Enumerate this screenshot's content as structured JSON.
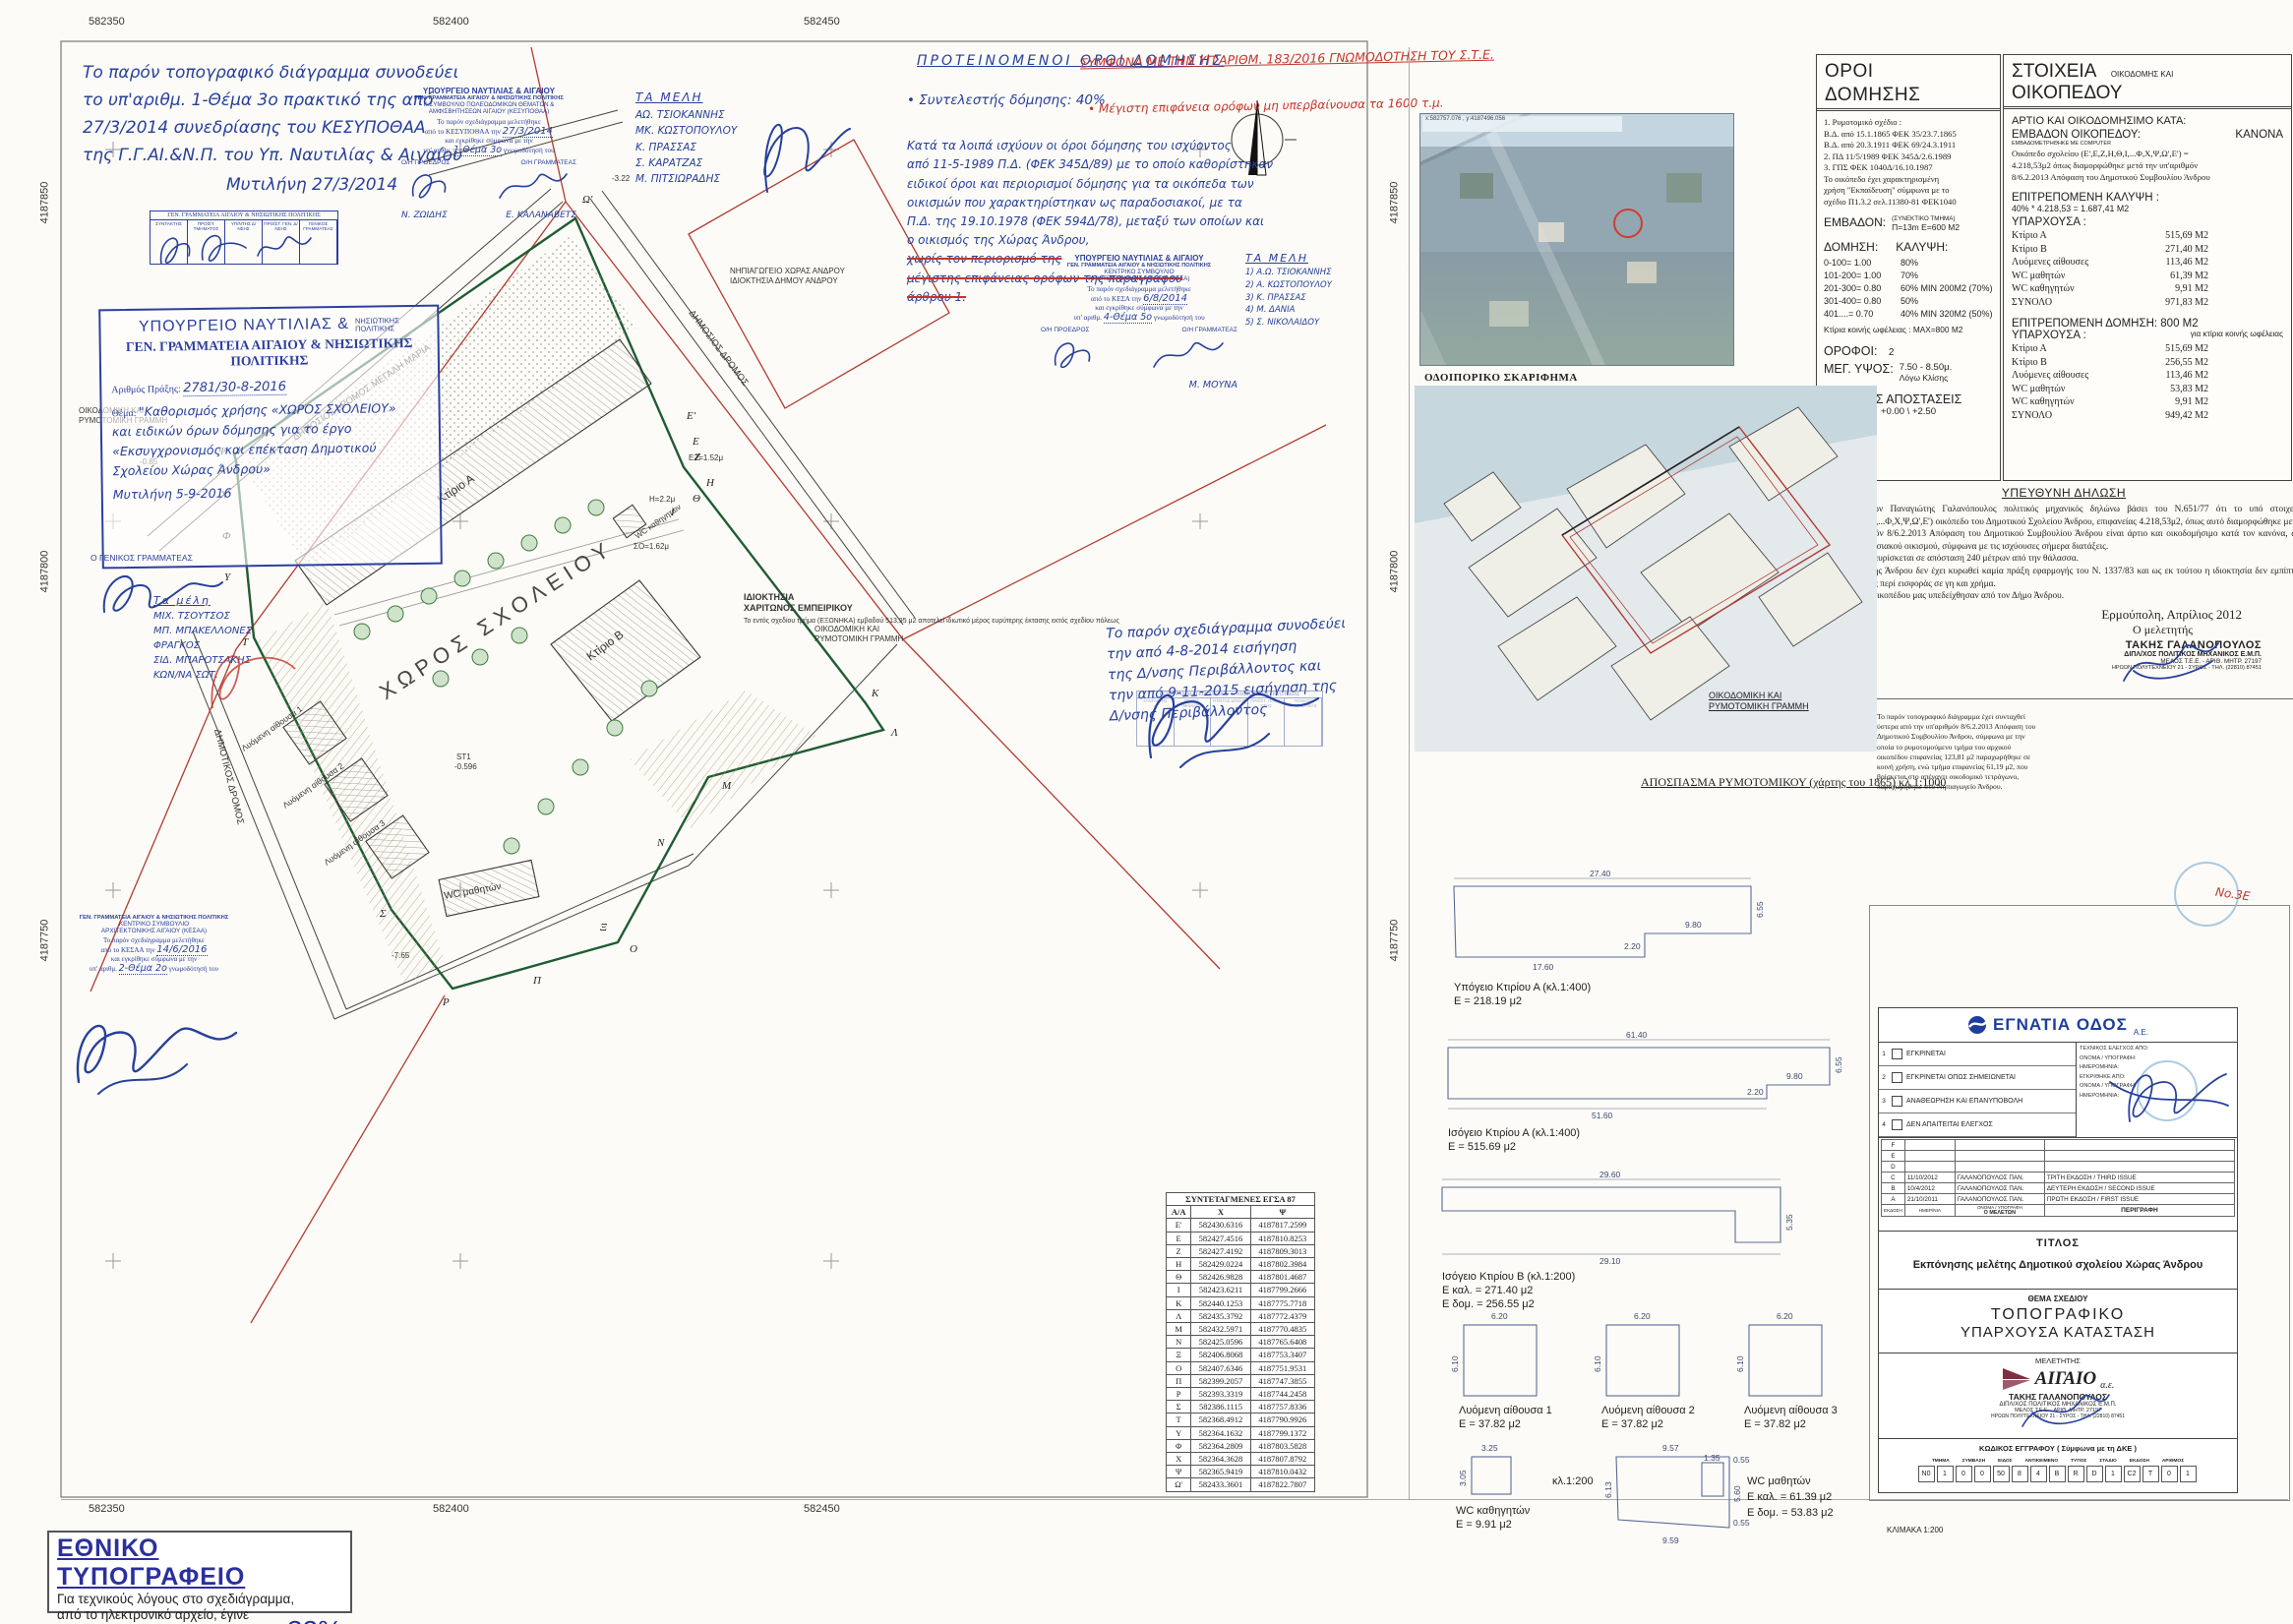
{
  "grid": {
    "top": [
      "582350",
      "582400",
      "582450"
    ],
    "bottom": [
      "582350",
      "582400",
      "582450"
    ],
    "left": [
      "4187850",
      "4187800",
      "4187750"
    ],
    "right": [
      "4187850",
      "4187800",
      "4187750"
    ]
  },
  "notes": {
    "top_left": "Το παρόν τοπογραφικό διάγραμμα συνοδεύει\nτο υπ'αριθμ. 1-Θέμα 3ο πρακτικό της από\n27/3/2014 συνεδρίασης του ΚΕΣΥΠΟΘΑΑ\nτης Γ.Γ.ΑΙ.&Ν.Π. του Υπ. Ναυτιλίας & Αιγαίου",
    "top_left_date": "Μυτιλήνη 27/3/2014",
    "mid_right": "Το παρόν σχεδιάγραμμα συνοδεύει\nτην από 4-8-2014 εισήγηση\nτης Δ/νσης Περιβάλλοντος και\nτην από 9-11-2015 εισήγηση της\nΔ/νσης Περιβάλλοντος"
  },
  "proposed": {
    "title": "ΠΡΟΤΕΙΝΟΜΕΝΟΙ ΟΡΟΙ ΔΟΜΗΣΗΣ",
    "red1": "ΣΥΜΦΩΝΑ ΜΕ ΤΗΝ ΥΠ'ΑΡΙΘΜ. 183/2016 ΓΝΩΜΟΔΟΤΗΣΗ ΤΟΥ Σ.Τ.Ε.",
    "red2": "• Μέγιστη επιφάνεια ορόφων μη υπερβαίνουσα τα 1600 τ.μ.",
    "line1": "• Συντελεστής δόμησης:  40%",
    "body": "Κατά τα λοιπά ισχύουν οι όροι δόμησης του ισχύοντος\nαπό 11-5-1989 Π.Δ. (ΦΕΚ 345Δ/89) με το οποίο καθορίστηκαν\nειδικοί όροι και περιορισμοί δόμησης για τα οικόπεδα των\nοικισμών που χαρακτηρίστηκαν ως παραδοσιακοί, με τα\nΠ.Δ. της 19.10.1978 (ΦΕΚ 594Δ/78), μεταξύ των οποίων και\nο οικισμός της Χώρας Άνδρου,",
    "struck": "χωρίς τον περιορισμό της\nμέγιστης επιφάνειας ορόφων της παραγράφου\nάρθρου 1."
  },
  "stamps": {
    "sig_table": {
      "header": "ΓΕΝ. ΓΡΑΜΜΑΤΕΙΑ ΑΙΓΑΙΟΥ & ΝΗΣΙΩΤΙΚΗΣ ΠΟΛΙΤΙΚΗΣ",
      "cols": [
        "ΣΥΝΤΑΚΤΗΣ",
        "ΠΡΟΪΣΤ. ΤΜΗΜΑΤΟΣ",
        "ΥΠ/ΝΤΗΣ Δ/ΝΣΗΣ",
        "ΠΡΟΪΣΤ. ΓΕΝ. Δ/ΝΣΗΣ",
        "ΓΕΝΙΚΟΣ ΓΡΑΜΜΑΤΕΑΣ"
      ]
    },
    "permit": {
      "title1a": "ΥΠΟΥΡΓΕΙΟ ΝΑΥΤΙΛΙΑΣ &",
      "title1b": "ΝΗΣΙΩΤΙΚΗΣ\nΠΟΛΙΤΙΚΗΣ",
      "title2": "ΓΕΝ. ΓΡΑΜΜΑΤΕΙΑ ΑΙΓΑΙΟΥ & ΝΗΣΙΩΤΙΚΗΣ ΠΟΛΙΤΙΚΗΣ",
      "num_label": "Αριθμός Πράξης:",
      "num_value": "2781/30-8-2016",
      "subject_label": "Θέμα:",
      "subject_value": "\"Καθορισμός χρήσης «ΧΩΡΟΣ ΣΧΟΛΕΙΟΥ»\nκαι ειδικών όρων δόμησης για το έργο\n«Εκσυγχρονισμός και επέκταση Δημοτικού\nΣχολείου Χώρας Άνδρου»",
      "date_value": "Μυτιλήνη 5-9-2016",
      "signer": "Ο ΓΕΝΙΚΟΣ ΓΡΑΜΜΑΤΕΑΣ"
    },
    "kesypothaa": {
      "l1": "ΥΠΟΥΡΓΕΙΟ ΝΑΥΤΙΛΙΑΣ & ΑΙΓΑΙΟΥ",
      "l2": "ΓΕΝ. ΓΡΑΜΜΑΤΕΙΑ ΑΙΓΑΙΟΥ & ΝΗΣΙΩΤΙΚΗΣ ΠΟΛΙΤΙΚΗΣ",
      "l3": "Κ.ΣΥΜΒΟΥΛΙΟ ΠΟΛΕΟΔΟΜΙΚΩΝ ΘΕΜΑΤΩΝ &",
      "l4": "ΑΜΦΙΣΒΗΤΗΣΕΩΝ ΑΙΓΑΙΟΥ (ΚΕΣΥΠΟΘΑΑ)",
      "l5": "Το παρόν σχεδιάγραμμα μελετήθηκε",
      "l6a": "από το ΚΕΣΥΠΟΘΑΑ την",
      "l6b": "27/3/2014",
      "l7": "και εγκρίθηκε σύμφωνα με την",
      "l8a": "υπ' αριθμ.",
      "l8b": "1-Θέμα 3ο",
      "l8c": "γνωμοδότησή του",
      "president": "Ο/Η ΠΡΟΕΔΡΟΣ",
      "secretary": "Ο/Η ΓΡΑΜΜΑΤΕΑΣ",
      "president_name": "Ν. ΖΩΙΔΗΣ",
      "secretary_name": "Ε. ΚΑΛΑΝΑΒΕΤΣ"
    },
    "kesa": {
      "l1": "ΥΠΟΥΡΓΕΙΟ ΝΑΥΤΙΛΙΑΣ & ΑΙΓΑΙΟΥ",
      "l2": "ΓΕΝ. ΓΡΑΜΜΑΤΕΙΑ ΑΙΓΑΙΟΥ & ΝΗΣΙΩΤΙΚΗΣ ΠΟΛΙΤΙΚΗΣ",
      "l3": "ΚΕΝΤΡΙΚΟ ΣΥΜΒΟΥΛΙΟ",
      "l4": "ΑΡΧΙΤΕΚΤΟΝΙΚΗΣ ΑΙΓΑΙΟΥ (ΚΕΣΑ)",
      "l5": "Το παρόν σχεδιάγραμμα μελετήθηκε",
      "l6a": "από το ΚΕΣΑ την",
      "l6b": "6/8/2014",
      "l7": "και εγκρίθηκε σύμφωνα με την",
      "l8a": "υπ' αριθμ.",
      "l8b": "4-Θέμα 5ο",
      "l8c": "γνωμοδότησή του",
      "president": "Ο/Η ΠΡΟΕΔΡΟΣ",
      "secretary": "Ο/Η ΓΡΑΜΜΑΤΕΑΣ",
      "secretary_name": "Μ. ΜΟΥΝΑ"
    },
    "kesaa": {
      "l1": "ΓΕΝ. ΓΡΑΜΜΑΤΕΙΑ ΑΙΓΑΙΟΥ & ΝΗΣΙΩΤΙΚΗΣ ΠΟΛΙΤΙΚΗΣ",
      "l2": "ΚΕΝΤΡΙΚΟ ΣΥΜΒΟΥΛΙΟ",
      "l3": "ΑΡΧΙΤΕΚΤΟΝΙΚΗΣ ΑΙΓΑΙΟΥ (ΚΕΣΑΑ)",
      "l4": "Το παρόν σχεδιάγραμμα μελετήθηκε",
      "l5a": "από το ΚΕΣΑΑ την",
      "l5b": "14/6/2016",
      "l6": "και εγκρίθηκε σύμφωνα με την",
      "l7a": "υπ' αριθμ.",
      "l7b": "2-Θέμα 2ο",
      "l7c": "γνωμοδότησή του"
    },
    "members1": {
      "title": "ΤΑ ΜΕΛΗ",
      "names": "ΑΩ. ΤΣΙΟΚΑΝΝΗΣ\nΜΚ. ΚΩΣΤΟΠΟΥΛΟΥ\nΚ. ΠΡΑΣΣΑΣ\nΣ. ΚΑΡΑΤΖΑΣ\nΜ. ΠΙΤΣΙΩΡΑΔΗΣ"
    },
    "members2": {
      "title": "ΤΑ ΜΕΛΗ",
      "names": "1) Α.Ω. ΤΣΙΟΚΑΝΝΗΣ\n2) Α. ΚΩΣΤΟΠΟΥΛΟΥ\n3) Κ. ΠΡΑΣΣΑΣ\n4) Μ. ΔΑΝΙΑ\n5) Σ. ΝΙΚΟΛΑΙΔΟΥ"
    },
    "members3": {
      "title": "Τα μέλη",
      "names": "ΜΙΧ. ΤΣΟΥΤΣΟΣ\nΜΠ. ΜΠΑΚΕΛΛΟΝΕΣ\nΦΡΑΓΚΟΣ\nΣΙΔ. ΜΠΑΡΟΤΣΑΚΗΣ\nΚΩΝ/ΝΑ ΣΩΤ."
    },
    "red_note": "Νο.3Ε"
  },
  "plan": {
    "school_area_label": "ΧΩΡΟΣ ΣΧΟΛΕΙΟΥ",
    "ktirio_a": "Κτίριο Α",
    "ktirio_b": "Κτίριο Β",
    "lyomeni_1": "Λυόμενη αίθουσα 1",
    "lyomeni_2": "Λυόμενη αίθουσα 2",
    "lyomeni_3": "Λυόμενη αίθουσα 3",
    "wc_math": "WC μαθητών",
    "wc_kath": "WC καθηγητών",
    "road1": "ΔΗΜΟΣΙΟΣ ΔΡΟΜΟΣ ΜΕΓΑΛΗ ΜΑΡΙΑ",
    "road2": "ΔΗΜΟΤΙΚΟΣ ΔΡΟΜΟΣ",
    "road3": "ΔΗΜΟΣΙΟΣ ΔΡΟΜΟΣ",
    "oikod_grammi_1": "ΟΙΚΟΔΟΜΙΚΗ ΚΑΙ",
    "oikod_grammi_2": "ΡΥΜΟΤΟΜΙΚΗ ΓΡΑΜΜΗ",
    "idioktisia_1": "ΙΔΙΟΚΤΗΣΙΑ",
    "idioktisia_2": "ΧΑΡΙΤΩΝΟΣ ΕΜΠΕΙΡΙΚΟΥ",
    "idioktisia_note": "Το εντός σχεδίου τμήμα\n(ΕΞΩΝΗΚΑ) εμβαδού 513,95 μ2\nαποτελεί ιδιωτικό μέρος\nευρύτερης έκτασης εκτός\nσχεδίου πόλεως",
    "nipiagogeio_1": "ΝΗΠΙΑΓΩΓΕΙΟ ΧΩΡΑΣ ΑΝΔΡΟΥ",
    "nipiagogeio_2": "ΙΔΙΟΚΤΗΣΙΑ ΔΗΜΟΥ ΑΝΔΡΟΥ",
    "st1a": "ST1",
    "st1b": "-0.596",
    "lv1": "-0.85",
    "lv2": "-3.22",
    "lv3": "-7.65",
    "lv4": "ΕΖ=1.52μ",
    "lv5": "Η=2.2μ",
    "lv6": "ΣΟ=1.62μ",
    "vertex_letters": [
      "Ω'",
      "Ε'",
      "Ε",
      "Ζ",
      "Η",
      "Θ",
      "Ι",
      "Κ",
      "Λ",
      "Μ",
      "Ν",
      "Ξ",
      "Ο",
      "Π",
      "Ρ",
      "Σ",
      "Τ",
      "Υ",
      "Φ",
      "Χ",
      "Ψ"
    ]
  },
  "aerial": {
    "caption": "ΟΔΟΙΠΟΡΙΚΟ ΣΚΑΡΙΦΗΜΑ",
    "coords": "x:582757.076 , y:4187496.056"
  },
  "oroi": {
    "t1": "ΟΡΟΙ",
    "t2": "ΔΟΜΗΣΗΣ",
    "law": "1. Ρυμοτομικό σχέδιο :\n    Β.Δ. από 15.1.1865 ΦΕΚ 35/23.7.1865\n    Β.Δ. από 20.3.1911 ΦΕΚ 69/24.3.1911\n2. ΠΔ 11/5/1989 ΦΕΚ 345Δ/2.6.1989\n3. ΓΠΣ ΦΕΚ 1040Δ/16.10.1987\n    Το οικόπεδο έχει χαρακτηρισμένη\n    χρήση \"Εκπαίδευση\" σύμφωνα με το\n    σχέδιο Π1.3.2 σελ.11380-81 ΦΕΚ1040",
    "emvadon_label": "ΕΜΒΑΔΟΝ:",
    "emvadon_note": "(ΣΥΝΕΚΤΙΚΟ ΤΜΗΜΑ)",
    "emvadon_value": "Π=13m  Ε=600 Μ2",
    "domisi_label": "ΔΟΜΗΣΗ:",
    "kalypsi_label": "ΚΑΛΥΨΗ:",
    "rows": [
      [
        "0-100= 1.00",
        "80%"
      ],
      [
        "101-200= 1.00",
        "70%"
      ],
      [
        "201-300= 0.80",
        "60% MIN 200M2 (70%)"
      ],
      [
        "301-400= 0.80",
        "50%"
      ],
      [
        "401....= 0.70",
        "40% MIN 320M2 (50%)"
      ]
    ],
    "koinis": "Κτίρια κοινής ωφέλειας : MAX=800 M2",
    "orofoi_label": "ΟΡΟΦΟΙ:",
    "orofoi_value": "2",
    "ypsos_label": "ΜΕΓ. ΥΨΟΣ:",
    "ypsos_value": "7.50 - 8.50μ.",
    "ypsos_note": "Λόγω Κλίσης",
    "plagies": "ΠΛΑΓΕΙΕΣ ΑΠΟΣΤΑΣΕΙΣ",
    "plagies_value": "+0.00 \\ +2.50"
  },
  "stoixeia": {
    "t1": "ΣΤΟΙΧΕΙΑ",
    "t1b": "ΟΙΚΟΔΟΜΗΣ ΚΑΙ",
    "t2": "ΟΙΚΟΠΕΔΟΥ",
    "artio": "ΑΡΤΙΟ ΚΑΙ ΟΙΚΟΔΟΜΗΣΙΜΟ ΚΑΤΑ:",
    "kanona": "ΚΑΝΟΝΑ",
    "emv_label": "ΕΜΒΑΔΟΝ ΟΙΚΟΠΕΔΟΥ:",
    "emv_note": "ΕΜΒΑΔΟΜΕΤΡΗΘΗΚΕ ΜΕ COMPUTER",
    "emv_text": "Οικόπεδο σχολείου (Ε',Ε,Ζ,Η,Θ,Ι,...Φ,Χ,Ψ,Ω',Ε') =\n4.218,53μ2 όπως διαμορφώθηκε μετά την υπ'αριθμόν\n8/6.2.2013 Απόφαση του Δημοτικού Συμβουλίου Άνδρου",
    "kalypsi_title": "ΕΠΙΤΡΕΠΟΜΕΝΗ ΚΑΛΥΨΗ :",
    "kalypsi_calc": "40% * 4.218,53 = 1.687,41 Μ2",
    "yparxousa1": "ΥΠΑΡΧΟΥΣΑ :",
    "table1": [
      {
        "label": "Κτίριο Α",
        "value": "515,69 Μ2"
      },
      {
        "label": "Κτίριο Β",
        "value": "271,40 Μ2"
      },
      {
        "label": "Λυόμενες αίθουσες",
        "value": "113,46 Μ2"
      },
      {
        "label": "WC μαθητών",
        "value": "61,39 Μ2"
      },
      {
        "label": "WC καθηγητών",
        "value": "9,91 Μ2"
      },
      {
        "label": "ΣΥΝΟΛΟ",
        "value": "971,83 Μ2"
      }
    ],
    "domisi_title": "ΕΠΙΤΡΕΠΟΜΕΝΗ ΔΟΜΗΣΗ: 800 Μ2",
    "domisi_note": "για κτίρια κοινής ωφέλειας",
    "yparxousa2": "ΥΠΑΡΧΟΥΣΑ :",
    "table2": [
      {
        "label": "Κτίριο Α",
        "value": "515,69 Μ2"
      },
      {
        "label": "Κτίριο Β",
        "value": "256,55 Μ2"
      },
      {
        "label": "Λυόμενες αίθουσες",
        "value": "113,46 Μ2"
      },
      {
        "label": "WC μαθητών",
        "value": "53,83 Μ2"
      },
      {
        "label": "WC καθηγητών",
        "value": "9,91 Μ2"
      },
      {
        "label": "ΣΥΝΟΛΟ",
        "value": "949,42 Μ2"
      }
    ]
  },
  "dilosi": {
    "title": "ΥΠΕΥΘΥΝΗ ΔΗΛΩΣΗ",
    "body": "Ο υπογράφων Παναγιώτης Γαλανόπουλος πολιτικός μηχανικός δηλώνω βάσει του Ν.651/77 ότι το υπό στοιχεία (Ε',Ε,Ζ,Η,Θ,Ι,...Φ,Χ,Ψ,Ω',Ε') οικόπεδο του Δημοτικού Σχολείου Άνδρου, επιφανείας 4.218,53μ2, όπως αυτό διαμορφώθηκε μετά την υπ'αριθμόν 8/6.2.2013 Απόφαση του Δημοτικού Συμβουλίου Άνδρου είναι άρτιο και οικοδομήσιμο κατά τον κανόνα, ως εντός παραδοσιακού οικισμού, σύμφωνα με τις ισχύουσες σήμερα διατάξεις.\nΤο οικόπεδο ευρίσκεται σε απόσταση 240 μέτρων από την θάλασσα.\nΣτην χώρα της Άνδρου δεν έχει κυρωθεί καμία πράξη εφαρμογής του Ν. 1337/83 και ως εκ τούτου η ιδιοκτησία δεν εμπίπτει στις διατάξεις περί εισφοράς σε γη και χρήμα.\nΤα όρια του οικοπέδου μας υπεδείχθησαν από τον Δήμο Άνδρου.",
    "place": "Ερμούπολη, Απρίλιος 2012",
    "role": "Ο μελετητής",
    "eng1": "ΤΑΚΗΣ ΓΑΛΑΝΟΠΟΥΛΟΣ",
    "eng2": "ΔΙΠΛ/ΧΟΣ ΠΟΛΙΤΙΚΟΣ ΜΗΧΑΝΙΚΟΣ Ε.Μ.Π.",
    "eng3": "ΜΕΛΟΣ Τ.Ε.Ε. - ΑΡΙΘ. ΜΗΤΡ. 27197",
    "eng4": "ΗΡΩΩΝ ΠΟΛΥΤΕΧΝΕΙΟΥ 21 - ΣΥΡΟΣ - ΤΗΛ. (22810) 87451"
  },
  "rymotomiko": {
    "label_1": "ΟΙΚΟΔΟΜΙΚΗ ΚΑΙ",
    "label_2": "ΡΥΜΟΤΟΜΙΚΗ ΓΡΑΜΜΗ",
    "caption": "ΑΠΟΣΠΑΣΜΑ ΡΥΜΟΤΟΜΙΚΟΥ (χάρτης του 1865) κλ 1:1000",
    "note": "Το παρόν τοπογραφικό διάγραμμα έχει συνταχθεί ύστερα από την υπ'αριθμόν 8/6.2.2013 Απόφαση του Δημοτικού Συμβουλίου Άνδρου, σύμφωνα με την οποία το ρυμοτομούμενο τμήμα του αρχικού οικοπέδου επιφανείας 123,81 μ2 παραχωρήθηκε σε κοινή χρήση, ενώ τμήμα επιφανείας 61,19 μ2, που βρίσκεται στο απέναντι οικοδομικό τετράγωνο, παραχωρήθηκε στο Νηπιαγωγείο Άνδρου."
  },
  "floor_plans": {
    "f1_caption": "Υπόγειο Κτιρίου Α (κλ.1:400)",
    "f1_area": "Ε = 218.19 μ2",
    "f1_d1": "27.40",
    "f1_d2": "6.55",
    "f1_d3": "9.80",
    "f1_d4": "2.20",
    "f1_d5": "17.60",
    "f2_caption": "Ισόγειο Κτιρίου Α (κλ.1:400)",
    "f2_area": "Ε = 515.69 μ2",
    "f2_d1": "61.40",
    "f2_d2": "6.55",
    "f2_d3": "9.80",
    "f2_d4": "2.20",
    "f2_d5": "51.60",
    "f3_caption": "Ισόγειο Κτιρίου Β (κλ.1:200)",
    "f3_area1": "Ε καλ. = 271.40 μ2",
    "f3_area2": "Ε δομ. = 256.55 μ2",
    "f3_d1": "29.60",
    "f3_d2": "29.10",
    "f3_d3": "5.35",
    "l_caption1": "Λυόμενη αίθουσα 1",
    "l_caption2": "Λυόμενη αίθουσα 2",
    "l_caption3": "Λυόμενη αίθουσα 3",
    "l_area": "Ε = 37.82 μ2",
    "l_d1": "6.20",
    "l_d2": "6.10",
    "wck_caption": "WC καθηγητών",
    "wck_area": "Ε = 9.91 μ2",
    "wck_d1": "3.25",
    "wck_d2": "3.05",
    "scale": "κλ.1:200",
    "wcm_caption": "WC μαθητών",
    "wcm_area1": "Ε καλ. = 61.39 μ2",
    "wcm_area2": "Ε δομ. = 53.83 μ2",
    "wcm_d1": "9.57",
    "wcm_d2": "6.13",
    "wcm_d3": "5.60",
    "wcm_d4": "9.59",
    "wcm_d5": "1.35",
    "wcm_d6": "0.55",
    "wcm_d7": "0.55"
  },
  "title_block": {
    "company": "ΕΓΝΑΤΙΑ ΟΔΟΣ",
    "company_suffix": "Α.Ε.",
    "approvals": [
      {
        "num": "1",
        "label": "ΕΓΚΡΙΝΕΤΑΙ"
      },
      {
        "num": "2",
        "label": "ΕΓΚΡΙΝΕΤΑΙ ΟΠΩΣ ΣΗΜΕΙΩΝΕΤΑΙ"
      },
      {
        "num": "3",
        "label": "ΑΝΑΘΕΩΡΗΣΗ ΚΑΙ ΕΠΑΝΥΠΟΒΟΛΗ"
      },
      {
        "num": "4",
        "label": "ΔΕΝ ΑΠΑΙΤΕΙΤΑΙ ΕΛΕΓΧΟΣ"
      }
    ],
    "check_labels": [
      "ΤΕΧΝΙΚΟΣ ΕΛΕΓΧΟΣ ΑΠΟ:",
      "ΟΝΟΜΑ / ΥΠΟΓΡΑΦΗ:",
      "ΗΜΕΡΟΜΗΝΙΑ:",
      "ΕΓΚΡΙΘΗΚΕ ΑΠΟ:",
      "ΟΝΟΜΑ / ΥΠΟΓΡΑΦΗ:",
      "ΗΜΕΡΟΜΗΝΙΑ:"
    ],
    "revisions": [
      {
        "rev": "F",
        "date": "",
        "name": "",
        "desc": ""
      },
      {
        "rev": "E",
        "date": "",
        "name": "",
        "desc": ""
      },
      {
        "rev": "D",
        "date": "",
        "name": "",
        "desc": ""
      },
      {
        "rev": "C",
        "date": "11/10/2012",
        "name": "ΓΑΛΑΝΟΠΟΥΛΟΣ ΠΑΝ.",
        "desc": "ΤΡΙΤΗ ΕΚΔΟΣΗ / THIRD ISSUE"
      },
      {
        "rev": "B",
        "date": "10/4/2012",
        "name": "ΓΑΛΑΝΟΠΟΥΛΟΣ ΠΑΝ.",
        "desc": "ΔΕΥΤΕΡΗ ΕΚΔΟΣΗ / SECOND ISSUE"
      },
      {
        "rev": "A",
        "date": "21/10/2011",
        "name": "ΓΑΛΑΝΟΠΟΥΛΟΣ ΠΑΝ.",
        "desc": "ΠΡΩΤΗ ΕΚΔΟΣΗ / FIRST ISSUE"
      }
    ],
    "rf1": "ΕΚΔΟΣΗ",
    "rf2": "ΗΜΕΡ/ΝΙΑ",
    "rf3": "ΟΝΟΜΑ / ΥΠΟΓΡΑΦΗ",
    "rf4": "Ο ΜΕΛΕΤΩΝ",
    "rf5": "ΠΕΡΙΓΡΑΦΗ",
    "titlos_label": "ΤΙΤΛΟΣ",
    "titlos": "Εκπόνησης μελέτης Δημοτικού σχολείου Χώρας Άνδρου",
    "thema_label": "ΘΕΜΑ ΣΧΕΔΙΟΥ",
    "thema1": "ΤΟΠΟΓΡΑΦΙΚΟ",
    "thema2": "ΥΠΑΡΧΟΥΣΑ ΚΑΤΑΣΤΑΣΗ",
    "meletitis_label": "ΜΕΛΕΤΗΤΗΣ",
    "aigaio": "ΑΙΓΑΙΟ",
    "aigaio_suffix": "α.ε.",
    "kodikos_label": "ΚΩΔΙΚΟΣ ΕΓΓΡΑΦΟΥ ( Σύμφωνα με τη ΔΚΕ )",
    "code_labels": [
      "ΤΜΗΜΑ",
      "ΣΥΜΒΑΣΗ",
      "ΕΙΔΟΣ",
      "ΑΝΤΙΚΕΙΜΕΝΟ",
      "ΤΥΠΟΣ",
      "ΣΤΑΔΙΟ",
      "ΕΚΔΟΣΗ",
      "ΑΡΙΘΜΟΣ"
    ],
    "code_boxes": [
      "Ν0",
      "1",
      "0",
      "0",
      "50",
      "8",
      "4",
      "Β",
      "R",
      "D",
      "1",
      "C2",
      "T",
      "0",
      "1"
    ],
    "klimaka": "ΚΛΙΜΑΚΑ 1:200"
  },
  "coords": {
    "title": "ΣΥΝΤΕΤΑΓΜΕΝΕΣ ΕΓΣΑ 87",
    "headers": [
      "Α/Α",
      "Χ",
      "Ψ"
    ],
    "rows": [
      [
        "Ε'",
        "582430.6316",
        "4187817.2599"
      ],
      [
        "Ε",
        "582427.4516",
        "4187810.8253"
      ],
      [
        "Ζ",
        "582427.4192",
        "4187809.3013"
      ],
      [
        "Η",
        "582429.0224",
        "4187802.3984"
      ],
      [
        "Θ",
        "582426.9828",
        "4187801.4687"
      ],
      [
        "Ι",
        "582423.6211",
        "4187799.2666"
      ],
      [
        "Κ",
        "582440.1253",
        "4187775.7718"
      ],
      [
        "Λ",
        "582435.3792",
        "4187772.4379"
      ],
      [
        "Μ",
        "582432.5971",
        "4187770.4835"
      ],
      [
        "Ν",
        "582425.0596",
        "4187765.6408"
      ],
      [
        "Ξ",
        "582406.8068",
        "4187753.3407"
      ],
      [
        "Ο",
        "582407.6346",
        "4187751.9531"
      ],
      [
        "Π",
        "582399.2057",
        "4187747.3855"
      ],
      [
        "Ρ",
        "582393.3319",
        "4187744.2458"
      ],
      [
        "Σ",
        "582386.1115",
        "4187757.8336"
      ],
      [
        "Τ",
        "582368.4912",
        "4187790.9926"
      ],
      [
        "Υ",
        "582364.1632",
        "4187799.1372"
      ],
      [
        "Φ",
        "582364.2809",
        "4187803.5828"
      ],
      [
        "Χ",
        "582364.3628",
        "4187807.8792"
      ],
      [
        "Ψ",
        "582365.9419",
        "4187810.0432"
      ],
      [
        "Ω'",
        "582433.3601",
        "4187822.7807"
      ]
    ]
  },
  "typografeio": {
    "title": "ΕΘΝΙΚΟ ΤΥΠΟΓΡΑΦΕΙΟ",
    "line1": "Για τεχνικούς λόγους στο σχεδιάγραμμα,",
    "line2": "από το ηλεκτρονικό αρχείο, έγινε",
    "line3": "σμίκρυνση κατά ποσοστό",
    "percent": "32%"
  },
  "colors": {
    "stamp_blue": "#2b3f9e",
    "hand_blue": "#27409c",
    "red": "#c2362b",
    "green": "#1f5c33"
  }
}
